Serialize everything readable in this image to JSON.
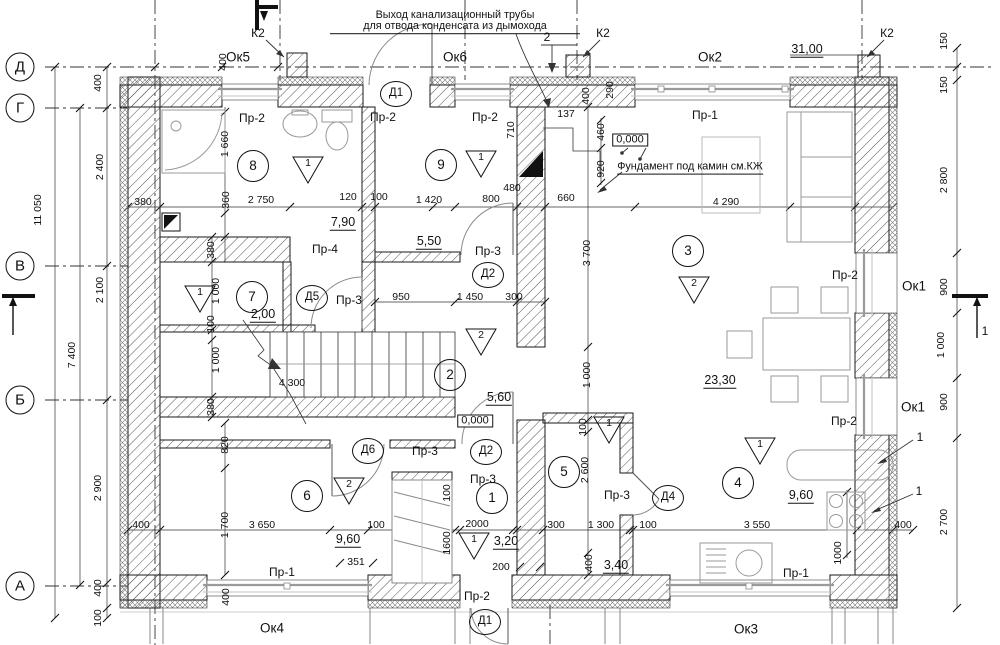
{
  "annotations": {
    "pipe_note_line1": "Выход канализационный трубы",
    "pipe_note_line2": "для отвода конденсата из дымохода",
    "fireplace_note": "Фундамент под камин см.КЖ"
  },
  "axes": {
    "rows": [
      {
        "label": "Д",
        "y": 67
      },
      {
        "label": "Г",
        "y": 108
      },
      {
        "label": "В",
        "y": 266
      },
      {
        "label": "Б",
        "y": 400
      },
      {
        "label": "А",
        "y": 586
      }
    ]
  },
  "windows": [
    {
      "label": "Ок5",
      "x": 238,
      "y": 57
    },
    {
      "label": "Ок6",
      "x": 455,
      "y": 57
    },
    {
      "label": "Ок2",
      "x": 710,
      "y": 57
    },
    {
      "label": "Ок1",
      "x": 914,
      "y": 286
    },
    {
      "label": "Ок1",
      "x": 913,
      "y": 407
    },
    {
      "label": "Ок4",
      "x": 272,
      "y": 628
    },
    {
      "label": "Ок3",
      "x": 746,
      "y": 629
    }
  ],
  "door_tags": [
    {
      "label": "Д1",
      "x": 396,
      "y": 94
    },
    {
      "label": "Д2",
      "x": 488,
      "y": 275
    },
    {
      "label": "Д5",
      "x": 312,
      "y": 298
    },
    {
      "label": "Д6",
      "x": 368,
      "y": 451
    },
    {
      "label": "Д2",
      "x": 486,
      "y": 452
    },
    {
      "label": "Д4",
      "x": 668,
      "y": 498
    },
    {
      "label": "Д1",
      "x": 485,
      "y": 622
    }
  ],
  "room_numbers": [
    {
      "n": "8",
      "x": 253,
      "y": 166
    },
    {
      "n": "9",
      "x": 441,
      "y": 165
    },
    {
      "n": "3",
      "x": 688,
      "y": 251
    },
    {
      "n": "7",
      "x": 252,
      "y": 297
    },
    {
      "n": "2",
      "x": 450,
      "y": 375
    },
    {
      "n": "6",
      "x": 307,
      "y": 496
    },
    {
      "n": "1",
      "x": 492,
      "y": 498
    },
    {
      "n": "5",
      "x": 564,
      "y": 472
    },
    {
      "n": "4",
      "x": 738,
      "y": 483
    }
  ],
  "floor_marks": [
    {
      "n": "1",
      "x": 308,
      "y": 170
    },
    {
      "n": "1",
      "x": 481,
      "y": 164
    },
    {
      "n": "1",
      "x": 200,
      "y": 299
    },
    {
      "n": "2",
      "x": 694,
      "y": 290
    },
    {
      "n": "2",
      "x": 481,
      "y": 342
    },
    {
      "n": "2",
      "x": 349,
      "y": 491
    },
    {
      "n": "1",
      "x": 609,
      "y": 430
    },
    {
      "n": "1",
      "x": 760,
      "y": 451
    },
    {
      "n": "1",
      "x": 474,
      "y": 546
    }
  ],
  "areas": [
    {
      "v": "31,00",
      "x": 807,
      "y": 50
    },
    {
      "v": "7,90",
      "x": 343,
      "y": 223
    },
    {
      "v": "5,50",
      "x": 429,
      "y": 242
    },
    {
      "v": "2,00",
      "x": 263,
      "y": 315
    },
    {
      "v": "23,30",
      "x": 720,
      "y": 381
    },
    {
      "v": "5,60",
      "x": 499,
      "y": 398
    },
    {
      "v": "9,60",
      "x": 348,
      "y": 540
    },
    {
      "v": "3,20",
      "x": 506,
      "y": 542
    },
    {
      "v": "3,40",
      "x": 616,
      "y": 566
    },
    {
      "v": "9,60",
      "x": 801,
      "y": 496
    }
  ],
  "lintel_tags": [
    {
      "label": "Пр-2",
      "x": 252,
      "y": 118
    },
    {
      "label": "Пр-2",
      "x": 383,
      "y": 117
    },
    {
      "label": "Пр-2",
      "x": 485,
      "y": 117
    },
    {
      "label": "Пр-1",
      "x": 705,
      "y": 115
    },
    {
      "label": "Пр-4",
      "x": 325,
      "y": 249
    },
    {
      "label": "Пр-3",
      "x": 488,
      "y": 251
    },
    {
      "label": "Пр-3",
      "x": 349,
      "y": 300
    },
    {
      "label": "Пр-2",
      "x": 845,
      "y": 275
    },
    {
      "label": "Пр-2",
      "x": 844,
      "y": 421
    },
    {
      "label": "Пр-3",
      "x": 425,
      "y": 451
    },
    {
      "label": "Пр-3",
      "x": 483,
      "y": 479
    },
    {
      "label": "Пр-3",
      "x": 617,
      "y": 495
    },
    {
      "label": "Пр-1",
      "x": 282,
      "y": 572
    },
    {
      "label": "Пр-1",
      "x": 796,
      "y": 573
    },
    {
      "label": "Пр-2",
      "x": 477,
      "y": 596
    }
  ],
  "dimensions": [
    {
      "v": "380",
      "x": 143,
      "y": 202
    },
    {
      "v": "2 750",
      "x": 261,
      "y": 200
    },
    {
      "v": "120",
      "x": 348,
      "y": 197
    },
    {
      "v": "100",
      "x": 379,
      "y": 197
    },
    {
      "v": "1 420",
      "x": 429,
      "y": 200
    },
    {
      "v": "800",
      "x": 491,
      "y": 199
    },
    {
      "v": "480",
      "x": 512,
      "y": 188
    },
    {
      "v": "660",
      "x": 566,
      "y": 198
    },
    {
      "v": "137",
      "x": 566,
      "y": 114
    },
    {
      "v": "4 290",
      "x": 726,
      "y": 202
    },
    {
      "v": "950",
      "x": 401,
      "y": 297
    },
    {
      "v": "1 450",
      "x": 470,
      "y": 297
    },
    {
      "v": "300",
      "x": 514,
      "y": 297
    },
    {
      "v": "4 300",
      "x": 292,
      "y": 383
    },
    {
      "v": "400",
      "x": 141,
      "y": 525
    },
    {
      "v": "3 650",
      "x": 262,
      "y": 525
    },
    {
      "v": "100",
      "x": 376,
      "y": 525
    },
    {
      "v": "2000",
      "x": 477,
      "y": 524
    },
    {
      "v": "300",
      "x": 556,
      "y": 525
    },
    {
      "v": "1 300",
      "x": 601,
      "y": 525
    },
    {
      "v": "100",
      "x": 648,
      "y": 525
    },
    {
      "v": "3 550",
      "x": 757,
      "y": 525
    },
    {
      "v": "400",
      "x": 903,
      "y": 525
    },
    {
      "v": "351",
      "x": 356,
      "y": 562
    },
    {
      "v": "200",
      "x": 501,
      "y": 567
    },
    {
      "v": "400",
      "x": 223,
      "y": 62,
      "r": 1
    },
    {
      "v": "1 660",
      "x": 225,
      "y": 144,
      "r": 1
    },
    {
      "v": "360",
      "x": 226,
      "y": 200,
      "r": 1
    },
    {
      "v": "710",
      "x": 511,
      "y": 130,
      "r": 1
    },
    {
      "v": "400",
      "x": 586,
      "y": 96,
      "r": 1
    },
    {
      "v": "290",
      "x": 610,
      "y": 90,
      "r": 1
    },
    {
      "v": "460",
      "x": 601,
      "y": 132,
      "r": 1
    },
    {
      "v": "920",
      "x": 601,
      "y": 169,
      "r": 1
    },
    {
      "v": "11 050",
      "x": 38,
      "y": 210,
      "r": 1
    },
    {
      "v": "7 400",
      "x": 72,
      "y": 355,
      "r": 1
    },
    {
      "v": "400",
      "x": 98,
      "y": 83,
      "r": 1
    },
    {
      "v": "2 400",
      "x": 100,
      "y": 167,
      "r": 1
    },
    {
      "v": "2 100",
      "x": 100,
      "y": 290,
      "r": 1
    },
    {
      "v": "2 900",
      "x": 98,
      "y": 488,
      "r": 1
    },
    {
      "v": "400",
      "x": 98,
      "y": 588,
      "r": 1
    },
    {
      "v": "100",
      "x": 98,
      "y": 618,
      "r": 1
    },
    {
      "v": "380",
      "x": 211,
      "y": 250,
      "r": 1
    },
    {
      "v": "1 000",
      "x": 216,
      "y": 291,
      "r": 1
    },
    {
      "v": "100",
      "x": 211,
      "y": 324,
      "r": 1
    },
    {
      "v": "1 000",
      "x": 216,
      "y": 360,
      "r": 1
    },
    {
      "v": "380",
      "x": 211,
      "y": 407,
      "r": 1
    },
    {
      "v": "820",
      "x": 225,
      "y": 445,
      "r": 1
    },
    {
      "v": "1 700",
      "x": 225,
      "y": 525,
      "r": 1
    },
    {
      "v": "400",
      "x": 226,
      "y": 597,
      "r": 1
    },
    {
      "v": "100",
      "x": 447,
      "y": 493,
      "r": 1
    },
    {
      "v": "1600",
      "x": 447,
      "y": 543,
      "r": 1
    },
    {
      "v": "100",
      "x": 583,
      "y": 427,
      "r": 1
    },
    {
      "v": "2 600",
      "x": 585,
      "y": 470,
      "r": 1
    },
    {
      "v": "400",
      "x": 589,
      "y": 563,
      "r": 1
    },
    {
      "v": "3 700",
      "x": 587,
      "y": 253,
      "r": 1
    },
    {
      "v": "1 000",
      "x": 587,
      "y": 375,
      "r": 1
    },
    {
      "v": "1000",
      "x": 838,
      "y": 553,
      "r": 1
    },
    {
      "v": "150",
      "x": 944,
      "y": 41,
      "r": 1
    },
    {
      "v": "150",
      "x": 944,
      "y": 85,
      "r": 1
    },
    {
      "v": "2 800",
      "x": 944,
      "y": 180,
      "r": 1
    },
    {
      "v": "900",
      "x": 944,
      "y": 287,
      "r": 1
    },
    {
      "v": "1 000",
      "x": 941,
      "y": 345,
      "r": 1
    },
    {
      "v": "900",
      "x": 944,
      "y": 402,
      "r": 1
    },
    {
      "v": "2 700",
      "x": 944,
      "y": 522,
      "r": 1
    }
  ],
  "elevation_marks": [
    {
      "v": "0,000",
      "x": 630,
      "y": 140
    },
    {
      "v": "0,000",
      "x": 475,
      "y": 421
    }
  ],
  "callouts": [
    {
      "t": "К2",
      "x": 258,
      "y": 33
    },
    {
      "t": "К2",
      "x": 603,
      "y": 33
    },
    {
      "t": "К2",
      "x": 887,
      "y": 33
    },
    {
      "t": "2",
      "x": 547,
      "y": 37
    },
    {
      "t": "1",
      "x": 920,
      "y": 437
    },
    {
      "t": "1",
      "x": 919,
      "y": 491
    },
    {
      "t": "1",
      "x": 985,
      "y": 331
    }
  ]
}
